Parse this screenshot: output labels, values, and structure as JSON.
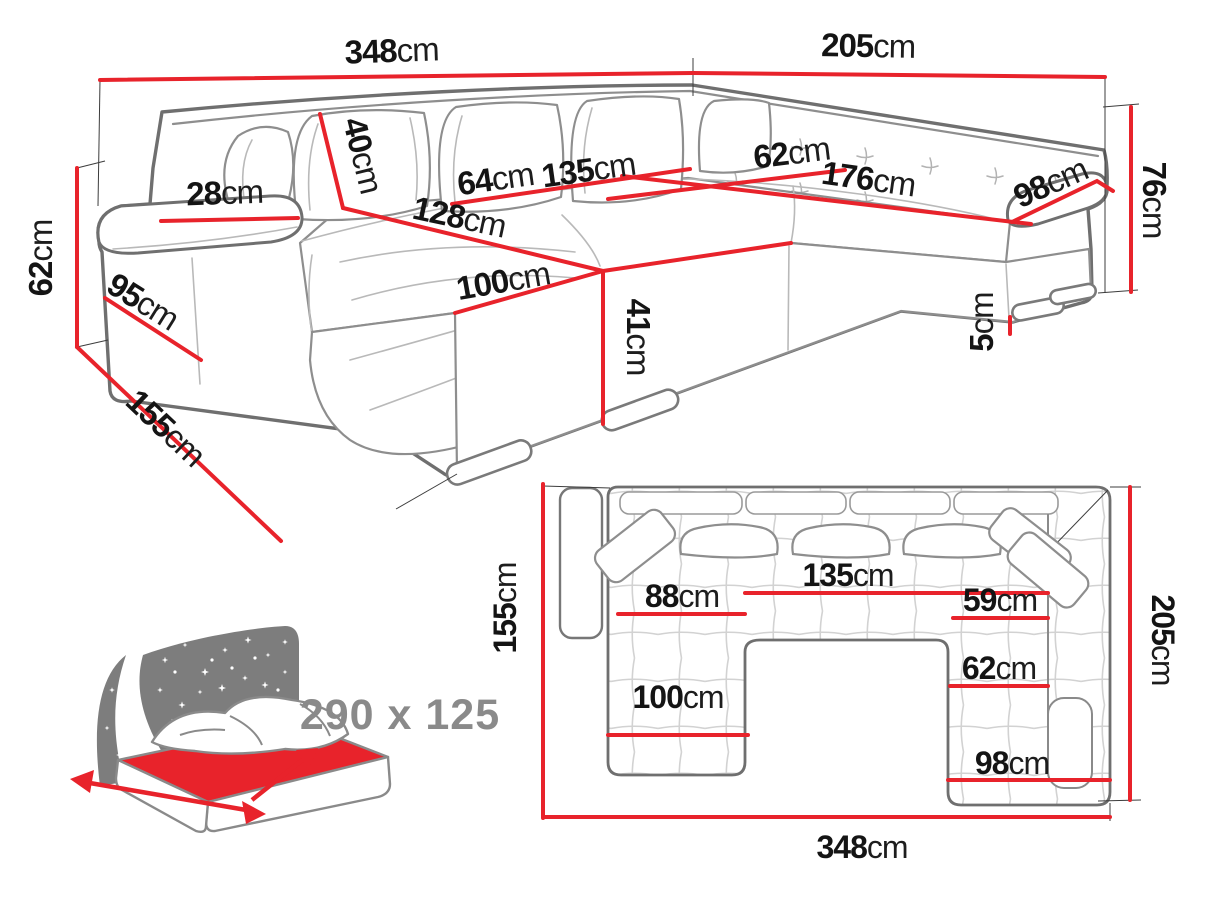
{
  "colors": {
    "dimension_line": "#e8232b",
    "sofa_outline": "#6f6f6f",
    "label_text": "#141414",
    "muted_text": "#8a8a8a",
    "icon_gray": "#7d7d7d"
  },
  "view_3d": {
    "back_width": {
      "value": "348",
      "unit": "cm"
    },
    "right_width": {
      "value": "205",
      "unit": "cm"
    },
    "total_height": {
      "value": "76",
      "unit": "cm"
    },
    "armrest_height": {
      "value": "62",
      "unit": "cm"
    },
    "side_depth": {
      "value": "155",
      "unit": "cm"
    },
    "armrest_front_depth": {
      "value": "95",
      "unit": "cm"
    },
    "armrest_top_width": {
      "value": "28",
      "unit": "cm"
    },
    "back_cushion_height": {
      "value": "40",
      "unit": "cm"
    },
    "left_seat_width": {
      "value": "64",
      "unit": "cm"
    },
    "center_seat_width": {
      "value": "135",
      "unit": "cm"
    },
    "corner_seat_depth": {
      "value": "62",
      "unit": "cm"
    },
    "right_seat_width": {
      "value": "176",
      "unit": "cm"
    },
    "right_armrest_length": {
      "value": "98",
      "unit": "cm"
    },
    "chaise_length": {
      "value": "128",
      "unit": "cm"
    },
    "chaise_width": {
      "value": "100",
      "unit": "cm"
    },
    "seat_height": {
      "value": "41",
      "unit": "cm"
    },
    "leg_height": {
      "value": "5",
      "unit": "cm"
    }
  },
  "plan_view": {
    "side_depth": {
      "value": "155",
      "unit": "cm"
    },
    "right_depth": {
      "value": "205",
      "unit": "cm"
    },
    "total_width": {
      "value": "348",
      "unit": "cm"
    },
    "left_seat_width": {
      "value": "88",
      "unit": "cm"
    },
    "center_seat_width": {
      "value": "135",
      "unit": "cm"
    },
    "right_seat_top": {
      "value": "59",
      "unit": "cm"
    },
    "right_seat_depth": {
      "value": "62",
      "unit": "cm"
    },
    "chaise_width": {
      "value": "100",
      "unit": "cm"
    },
    "right_chaise_width": {
      "value": "98",
      "unit": "cm"
    }
  },
  "sleeping_area": {
    "label": "290 x 125"
  }
}
